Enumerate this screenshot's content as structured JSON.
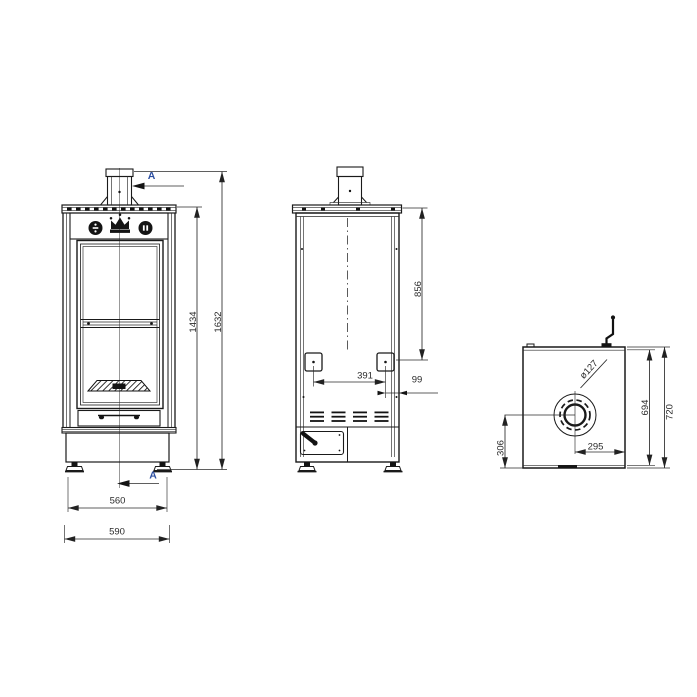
{
  "colors": {
    "line": "#1a1a1a",
    "dim_text": "#2b2b2b",
    "section_text": "#2d4fa1",
    "background": "#ffffff"
  },
  "icons": {
    "brand_emblem": "crown",
    "section_cut_arrow": "left-arrow",
    "left_knob_icon": "divide-dial",
    "right_knob_icon": "double-bar-dial"
  },
  "views": {
    "front": {
      "section_marker_top": "A",
      "section_marker_bottom": "A",
      "dims": {
        "body_height": "1434",
        "total_height": "1632",
        "feet_spacing": "560",
        "total_width": "590"
      }
    },
    "rear": {
      "dims": {
        "top_to_ports": "856",
        "port_spacing": "391",
        "port_edge_offset": "99"
      }
    },
    "top": {
      "dims": {
        "flue_diameter": "ø127",
        "inner_depth": "694",
        "total_depth": "720",
        "flue_center_from_front": "306",
        "flue_center_from_side": "295"
      }
    }
  }
}
